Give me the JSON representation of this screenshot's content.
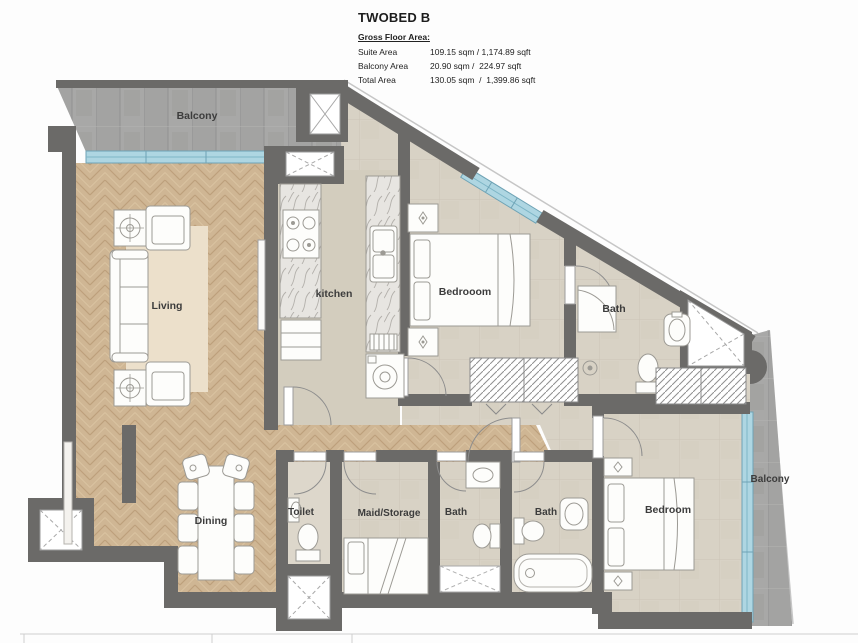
{
  "title_block": {
    "title": "TWOBED B",
    "section_label": "Gross Floor Area:",
    "rows": [
      {
        "label": "Suite Area",
        "value": "109.15 sqm / 1,174.89 sqft"
      },
      {
        "label": "Balcony Area",
        "value": "20.90 sqm /  224.97 sqft"
      },
      {
        "label": "Total Area",
        "value": "130.05 sqm  /  1,399.86 sqft"
      }
    ]
  },
  "rooms": {
    "balcony_top": "Balcony",
    "living": "Living",
    "kitchen": "kitchen",
    "bedroom1": "Bedrooom",
    "bath1": "Bath",
    "dining": "Dining",
    "toilet": "Toilet",
    "maid": "Maid/Storage",
    "bath2": "Bath",
    "bath3": "Bath",
    "bedroom2": "Bedroom",
    "balcony_right": "Balcony"
  },
  "colors": {
    "wall": "#6b6a68",
    "window_glass": "#aed6e2",
    "window_frame": "#6fa3b5",
    "wood_floor": "#cfb694",
    "tile_floor": "#d8d2c5",
    "concrete": "#a8a8a7",
    "rug": "#ece0cb"
  }
}
